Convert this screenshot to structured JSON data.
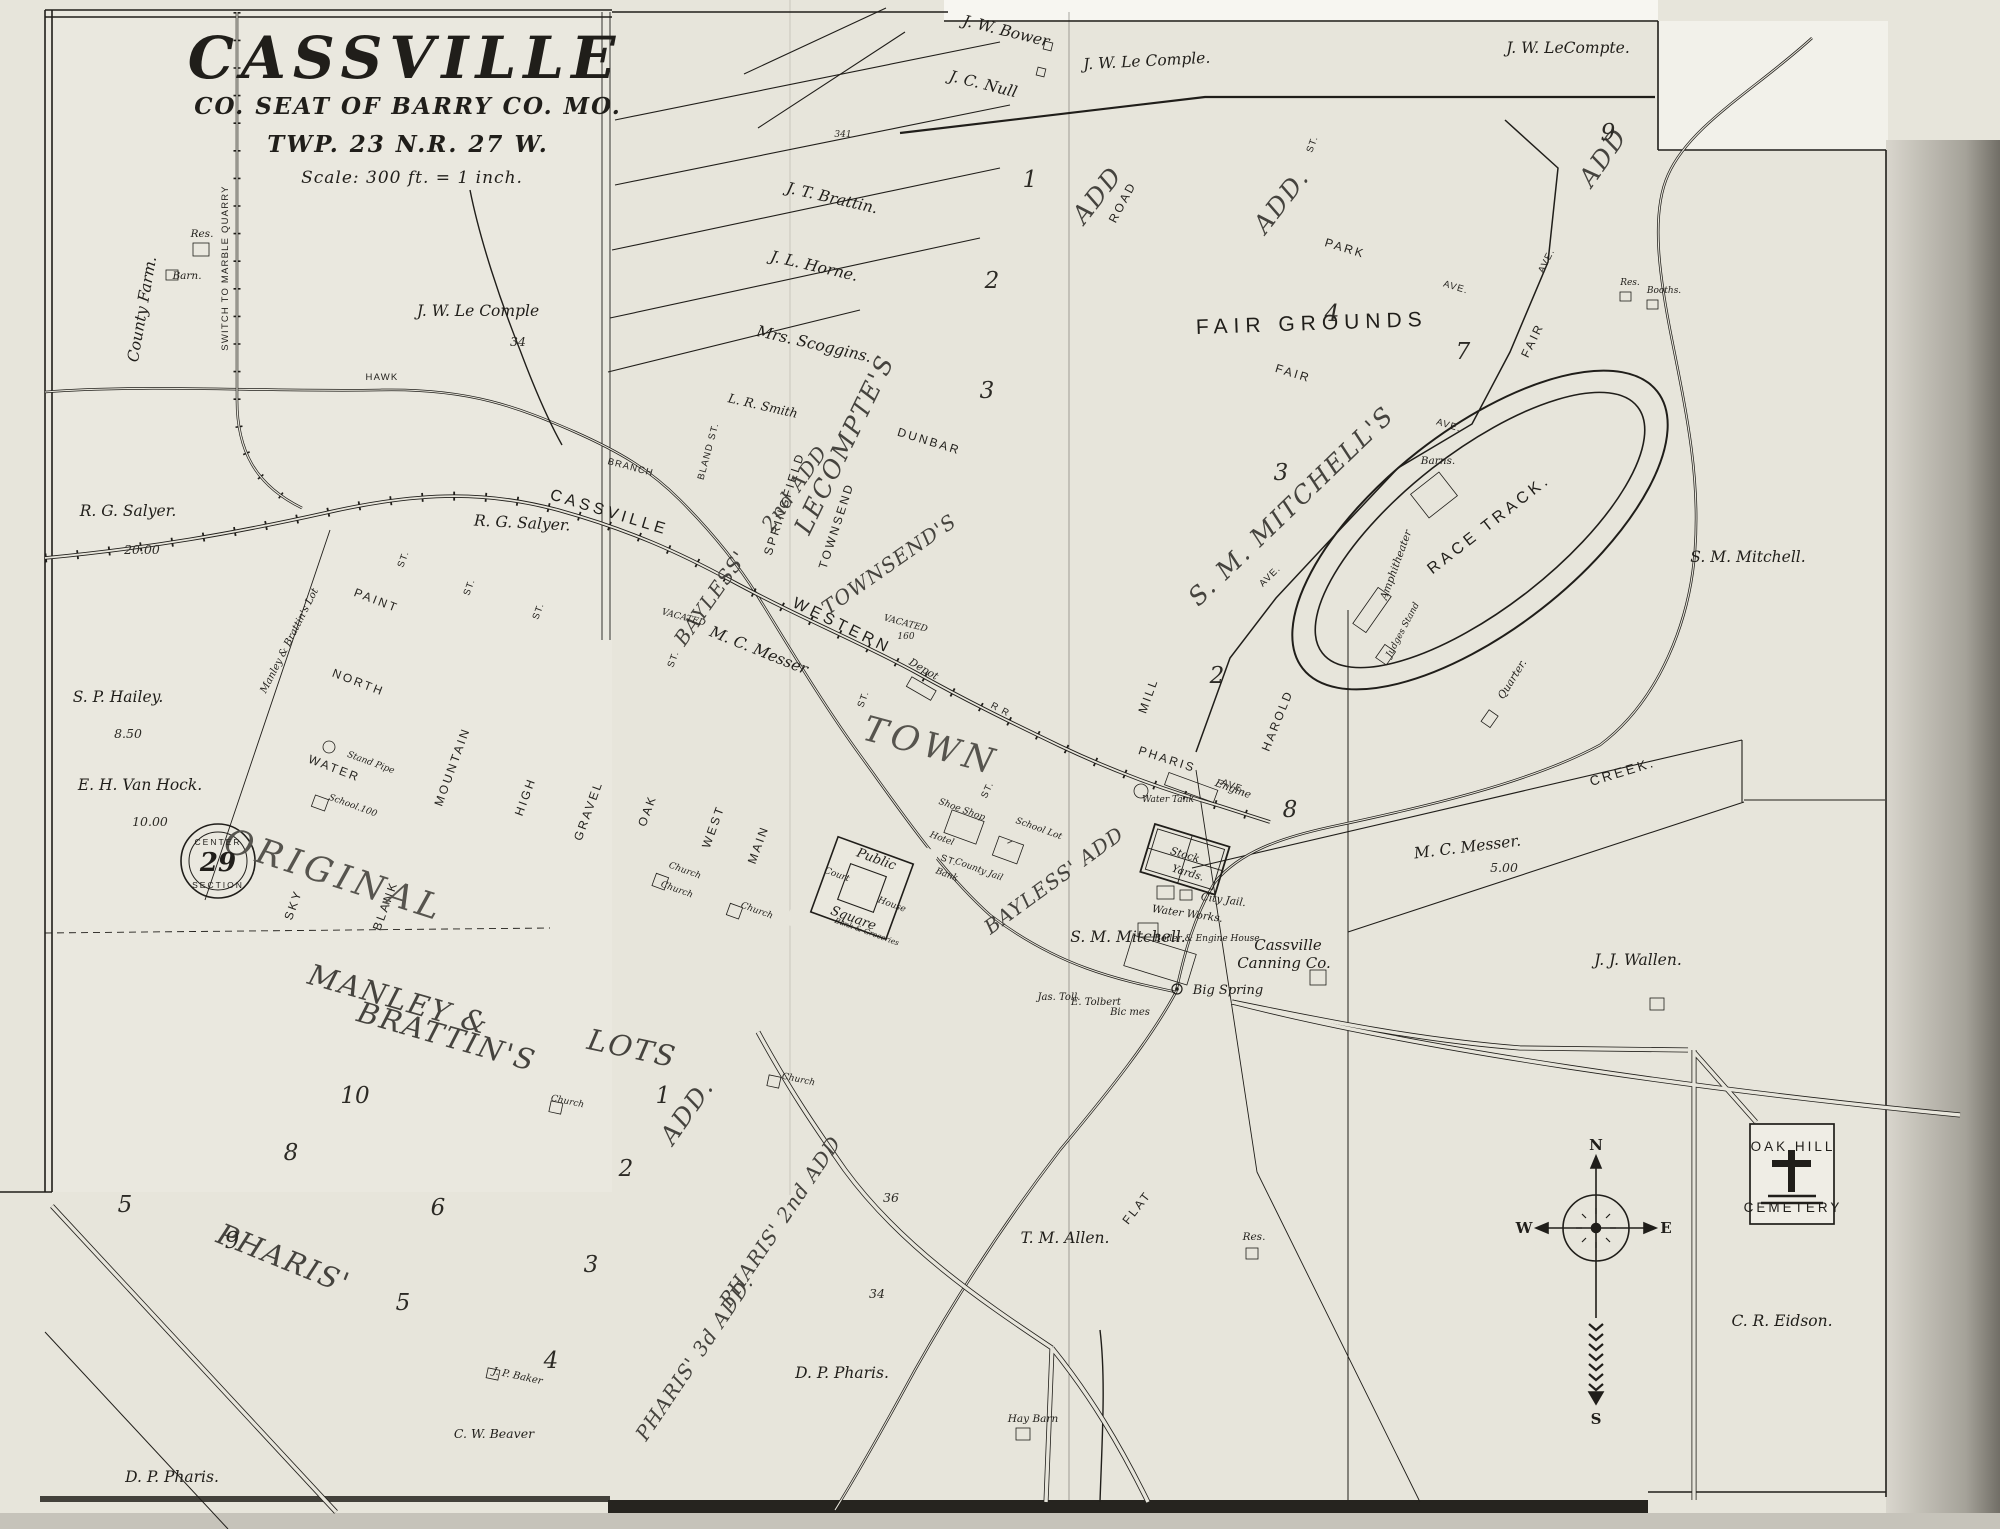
{
  "map_title": {
    "name": "CASSVILLE",
    "subtitle": "CO. SEAT OF BARRY CO. MO.",
    "township": "TWP. 23 N.R. 27 W.",
    "scale": "Scale: 300 ft. = 1 inch."
  },
  "colors": {
    "ink": "#201e1a",
    "paper": "#e7e5db"
  },
  "railroad": [
    "CASSVILLE",
    "WESTERN",
    "R R"
  ],
  "owners": [
    "J. W. Bower",
    "J. C. Null",
    "J. W. Le Comple.",
    "J. W. LeCompte.",
    "J. T. Brattin.",
    "J. L. Horne.",
    "Mrs. Scoggins.",
    "L. R. Smith",
    "J. W. Le Comple",
    "R. G. Salyer.",
    "R. G. Salyer.",
    "20.00",
    "S. P. Hailey.",
    "8.50",
    "E. H. Van Hock.",
    "10.00",
    "County Farm.",
    "M. C. Messer",
    "M. C. Messer.",
    "5.00",
    "J. J. Wallen.",
    "S. M. Mitchell.",
    "S. M. Mitchell.",
    "T. M. Allen.",
    "C. R. Eidson.",
    "D. P. Pharis.",
    "D. P. Pharis.",
    "C. W. Beaver",
    "J. P. Baker",
    "Jas. Toll.",
    "E. Tolbert",
    "Bic mes",
    "Manley & Brattin's Lot"
  ],
  "streets": [
    "PAINT",
    "NORTH",
    "WATER",
    "SKY",
    "BLANK",
    "MOUNTAIN",
    "HIGH",
    "GRAVEL",
    "OAK",
    "WEST",
    "MAIN",
    "BLAND ST.",
    "SPRINGFIELD",
    "TOWNSEND",
    "DUNBAR",
    "ROAD",
    "PARK",
    "AVE.",
    "FAIR",
    "AVE.",
    "FAIR",
    "AVE.",
    "MILL",
    "HAROLD",
    "PHARIS",
    "AVE.",
    "AVE.",
    "ST.",
    "ST.",
    "ST.",
    "ST.",
    "ST.",
    "ST.",
    "ST.",
    "ST.",
    "HAWK",
    "BRANCH",
    "CREEK.",
    "SWITCH TO MARBLE QUARRY",
    "FLAT"
  ],
  "additions": [
    "ORIGINAL",
    "TOWN",
    "MANLEY &",
    "BRATTIN'S",
    "LOTS",
    "PHARIS'",
    "ADD.",
    "PHARIS' 2nd ADD",
    "PHARIS' 3d ADD.",
    "BAYLESS'",
    "2nd ADD",
    "TOWNSEND'S",
    "LECOMPTE'S",
    "S. M. MITCHELL'S",
    "BAYLESS' ADD",
    "ADD",
    "ADD.",
    "ADD",
    "FAIR GROUNDS"
  ],
  "features": [
    "Res.",
    "Barn.",
    "Depot",
    "Water Tank",
    "Engine",
    "Stock",
    "Yards.",
    "City Jail.",
    "Water Works.",
    "Boiler & Engine House",
    "Cassville",
    "Canning Co.",
    "Big Spring",
    "Hay Barn",
    "Res.",
    "Res.",
    "Booths.",
    "Barns.",
    "Amphitheater",
    "Judges Stand",
    "Quarter.",
    "RACE TRACK.",
    "Public",
    "Square",
    "Court",
    "House",
    "Hotel",
    "Shoe Shop",
    "Bank",
    "County Jail",
    "School Lot",
    "Church",
    "Church",
    "Church",
    "Church",
    "Church",
    "School.100",
    "Stand Pipe",
    "VACATED",
    "VACATED",
    "Bank & Groceries",
    "OAK HILL",
    "CEMETERY"
  ],
  "numbers": [
    "10",
    "8",
    "9",
    "6",
    "5",
    "5",
    "2",
    "3",
    "4",
    "1",
    "1",
    "2",
    "3",
    "4",
    "7",
    "3",
    "2",
    "8",
    "9",
    "34",
    "34",
    "36",
    "341",
    "160"
  ],
  "compass": {
    "n": "N",
    "w": "W",
    "e": "E",
    "s": "S"
  },
  "stamp": {
    "top": "CENTER",
    "num": "29",
    "bottom": "SECTION"
  }
}
